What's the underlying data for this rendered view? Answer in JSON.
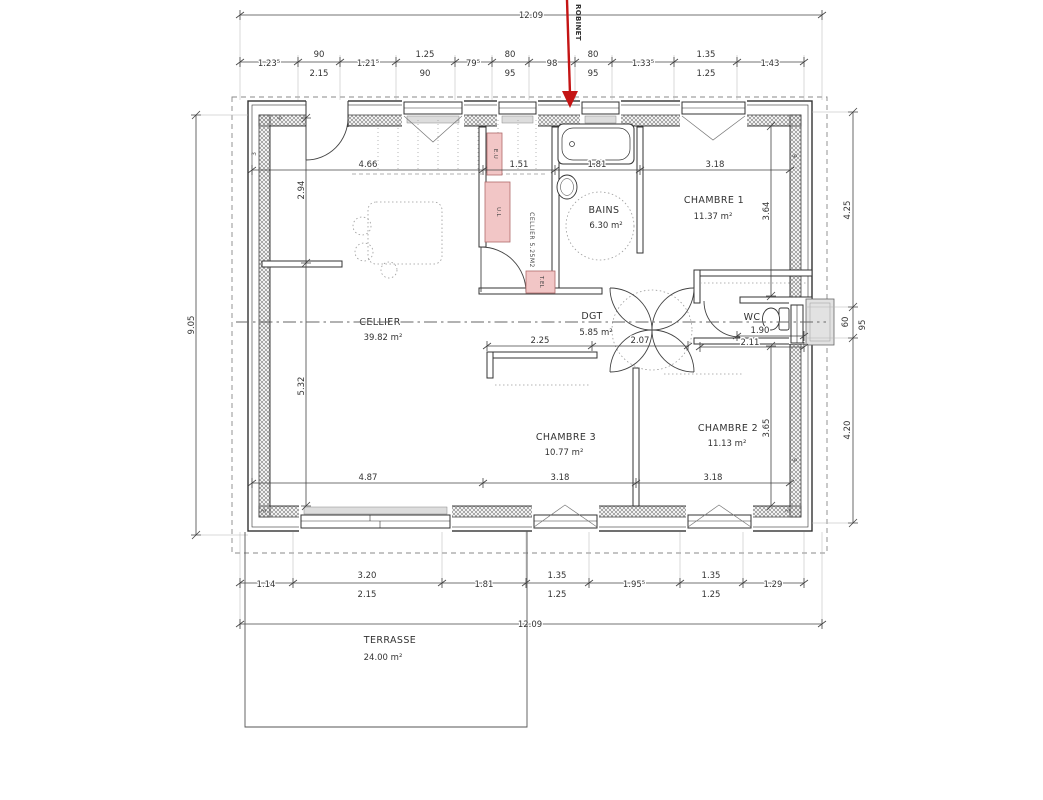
{
  "annotation": {
    "robinet_label": "ROBINET"
  },
  "colors": {
    "red_arrow": "#c41414",
    "blue_label": "#2244aa",
    "pink_fill": "#f2c6c6",
    "pink_stroke": "#b06a6a"
  },
  "dims": {
    "top_overall": "12.09",
    "top_chain": [
      "1.23⁵",
      "90",
      "2.15",
      "1.21⁵",
      "1.25",
      "90",
      "79⁵",
      "80",
      "95",
      "98",
      "80",
      "95",
      "1.33⁵",
      "1.35",
      "1.25",
      "1.43"
    ],
    "left_overall": "9.05",
    "right_chain": [
      "4.25",
      "60",
      "95",
      "4.20"
    ],
    "bottom_chain": [
      "1.14",
      "3.20",
      "2.15",
      "1.81",
      "1.35",
      "1.25",
      "1.95⁵",
      "1.35",
      "1.25",
      "1.29"
    ],
    "bottom_overall": "12.09",
    "interior": {
      "cellier_w": "4.66",
      "closet_w": "1.51",
      "bains_w": "1.81",
      "ch1_w": "3.18",
      "cellier_h_top": "2.94",
      "cellier_h_bot": "5.32",
      "ch1_h": "3.64",
      "ch3_top_w": "2.25",
      "dgt_w": "2.07",
      "wc_w1": "1.90",
      "wc_w2": "2.11",
      "ch2_h": "3.65",
      "cellier_bot_w": "4.87",
      "ch3_w": "3.18",
      "ch2_w": "3.18"
    }
  },
  "rooms": {
    "cellier": {
      "name": "CELLIER",
      "area": "39.82 m²"
    },
    "closet": {
      "name": "CELLIER 5.25M2"
    },
    "bains": {
      "name": "BAINS",
      "area": "6.30 m²"
    },
    "chambre1": {
      "name": "CHAMBRE 1",
      "area": "11.37 m²"
    },
    "chambre2": {
      "name": "CHAMBRE 2",
      "area": "11.13 m²"
    },
    "chambre3": {
      "name": "CHAMBRE 3",
      "area": "10.77 m²"
    },
    "wc": {
      "name": "WC"
    },
    "dgt": {
      "name": "DGT",
      "area": "5.85 m²"
    },
    "terrasse": {
      "name": "TERRASSE",
      "area": "24.00 m²"
    }
  },
  "equipment": {
    "eu": "E.U",
    "ul": "U.L",
    "tel": "T.EL"
  },
  "wall_marks": [
    "6",
    "3",
    "6",
    "3",
    "3",
    "6"
  ]
}
